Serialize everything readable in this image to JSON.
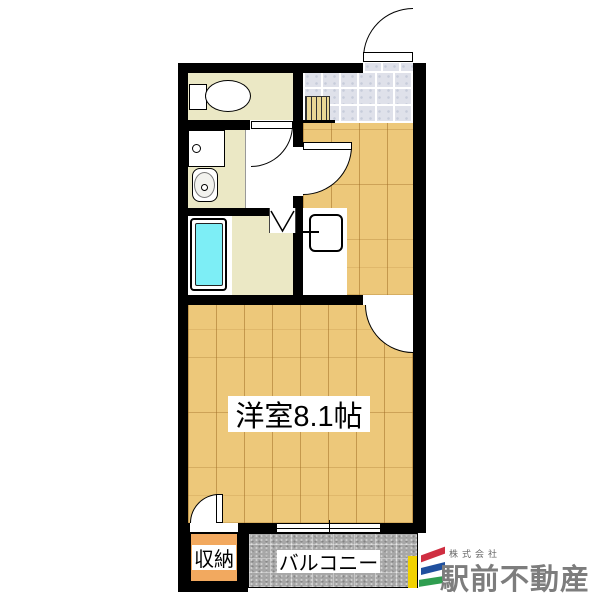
{
  "plan": {
    "labels": {
      "main_room": "洋室8.1帖",
      "closet": "収納",
      "balcony": "バルコニー"
    },
    "colors": {
      "wall": "#000000",
      "wood_floor": "#edc87a",
      "wet_area_floor": "#ebe8c5",
      "entrance_tile": "#dfe1ea",
      "bathtub": "#7deef6",
      "closet_fill": "#f2a95f",
      "balcony_fill": "#a7a7a7"
    }
  },
  "logo": {
    "company_prefix": "株式会社",
    "company_name": "駅前不動産",
    "colors": {
      "red": "#cf2e41",
      "blue": "#20509e",
      "green": "#2f9e50",
      "yellow": "#f2d200",
      "text": "#7d7d7d"
    }
  }
}
